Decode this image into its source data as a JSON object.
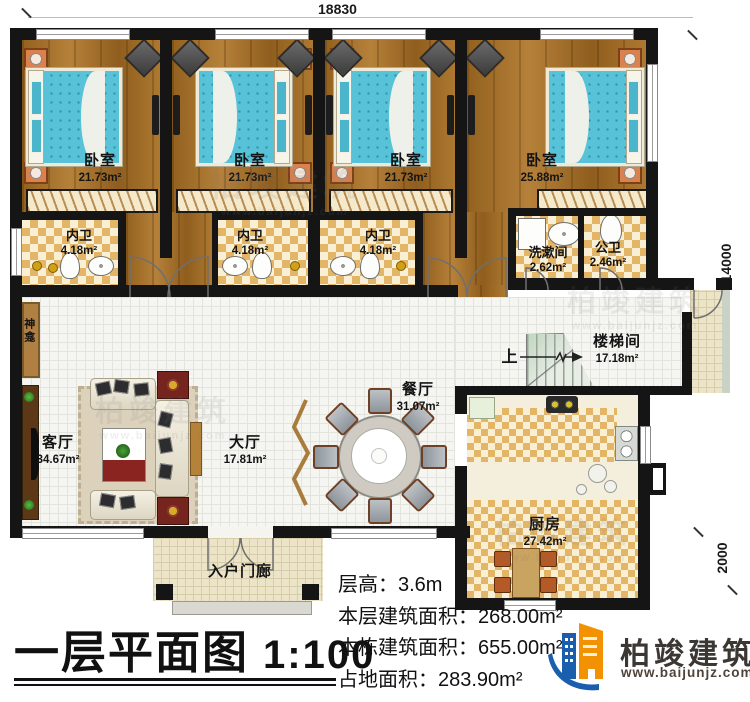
{
  "dimensions": {
    "top": "18830",
    "right_upper": "14000",
    "right_lower": "2000"
  },
  "rooms": {
    "bedroom1": {
      "name": "卧室",
      "area": "21.73m²"
    },
    "bedroom2": {
      "name": "卧室",
      "area": "21.73m²"
    },
    "bedroom3": {
      "name": "卧室",
      "area": "21.73m²"
    },
    "bedroom4": {
      "name": "卧室",
      "area": "25.88m²"
    },
    "ensuite1": {
      "name": "内卫",
      "area": "4.18m²"
    },
    "ensuite2": {
      "name": "内卫",
      "area": "4.18m²"
    },
    "ensuite3": {
      "name": "内卫",
      "area": "4.18m²"
    },
    "washroom": {
      "name": "洗漱间",
      "area": "2.62m²"
    },
    "public_wc": {
      "name": "公卫",
      "area": "2.46m²"
    },
    "living_room": {
      "name": "客厅",
      "area": "34.67m²"
    },
    "hall": {
      "name": "大厅",
      "area": "17.81m²"
    },
    "dining_room": {
      "name": "餐厅",
      "area": "31.07m²"
    },
    "stairwell": {
      "name": "楼梯间",
      "area": "17.18m²"
    },
    "kitchen": {
      "name": "厨房",
      "area": "27.42m²"
    },
    "entry_porch": {
      "name": "入户门廊"
    },
    "shrine": {
      "name": "神龛"
    }
  },
  "stairs_up_label": "上",
  "info_lines": [
    {
      "label": "层高：",
      "value": "3.6m"
    },
    {
      "label": "本层建筑面积：",
      "value": "268.00m²"
    },
    {
      "label": "本栋建筑面积：",
      "value": "655.00m²"
    },
    {
      "label": "占地面积：",
      "value": "283.90m²"
    }
  ],
  "title": {
    "text": "一层平面图",
    "scale": "1:100"
  },
  "brand": {
    "name": "柏竣建筑",
    "url": "www.baijunjz.com"
  },
  "watermark": {
    "name": "柏竣建筑",
    "url": "www.baijunjz.com"
  },
  "colors": {
    "wall": "#151515",
    "wood_floor": "#a26e2a",
    "bed_teal": "#57c2d8",
    "tile_checker": "#e2b567",
    "brand_blue": "#1a5fae",
    "brand_orange": "#f29200"
  }
}
